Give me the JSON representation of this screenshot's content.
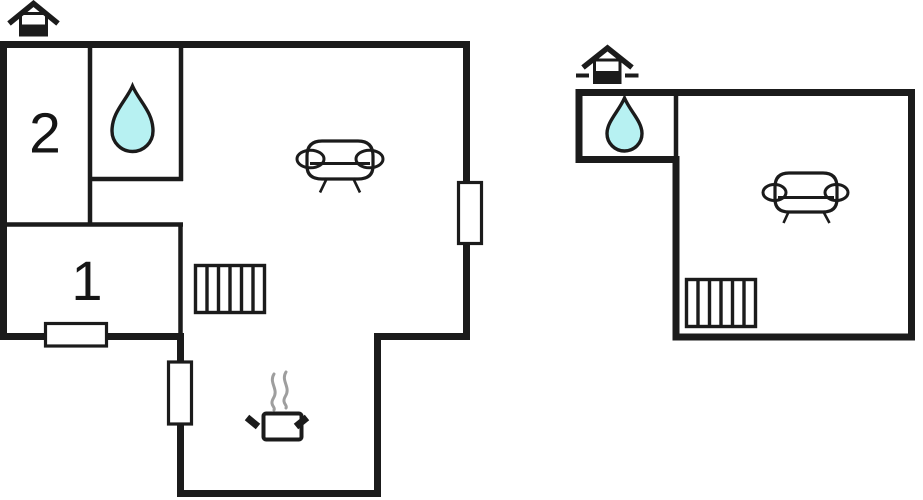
{
  "colors": {
    "background": "#ffffff",
    "wall": "#1b1b1b",
    "water": "#b7f1f2",
    "steam": "#9e9e9e"
  },
  "ground_floor_plan": {
    "level_icon": "house-ground-floor-icon",
    "room_labels": {
      "room_2": "2",
      "room_1": "1"
    },
    "feature_icons": [
      "water-drop-icon",
      "sofa-icon",
      "radiator-icon",
      "stove-pot-icon",
      "steam-icon",
      "window-marker-bottom",
      "window-marker-kitchen",
      "window-marker-right"
    ]
  },
  "upper_floor_plan": {
    "level_icon": "house-upper-floor-icon",
    "room_labels": {},
    "feature_icons": [
      "water-drop-icon",
      "sofa-icon",
      "radiator-icon"
    ]
  }
}
